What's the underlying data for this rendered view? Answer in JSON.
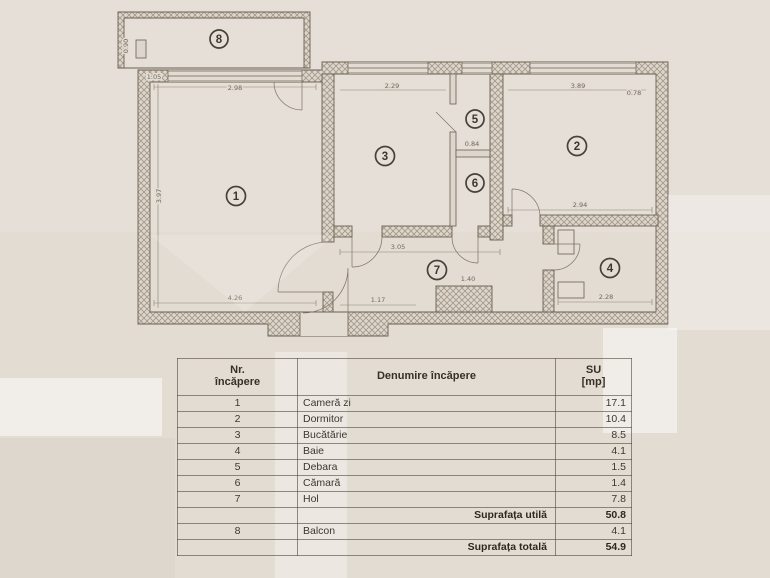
{
  "plan": {
    "room_numbers": [
      "1",
      "2",
      "3",
      "4",
      "5",
      "6",
      "7",
      "8"
    ],
    "dimension_labels": [
      "2.98",
      "3.97",
      "4.26",
      "2.29",
      "3.89",
      "0.78",
      "2.94",
      "2.28",
      "3.05",
      "1.17",
      "0.84",
      "1.40",
      "1.05",
      "0.90"
    ],
    "colors": {
      "paper": "#e3dcd3",
      "line": "#6a6052",
      "hatch": "#a39a8c",
      "ink": "#3d382f"
    }
  },
  "table": {
    "header": {
      "nr_line1": "Nr.",
      "nr_line2": "încăpere",
      "name": "Denumire încăpere",
      "su_line1": "SU",
      "su_line2": "[mp]"
    },
    "rows": [
      {
        "nr": "1",
        "name": "Cameră zi",
        "su": "17.1"
      },
      {
        "nr": "2",
        "name": "Dormitor",
        "su": "10.4"
      },
      {
        "nr": "3",
        "name": "Bucătărie",
        "su": "8.5"
      },
      {
        "nr": "4",
        "name": "Baie",
        "su": "4.1"
      },
      {
        "nr": "5",
        "name": "Debara",
        "su": "1.5"
      },
      {
        "nr": "6",
        "name": "Cămară",
        "su": "1.4"
      },
      {
        "nr": "7",
        "name": "Hol",
        "su": "7.8"
      },
      {
        "nr": "",
        "name": "Suprafața utilă",
        "su": "50.8"
      },
      {
        "nr": "8",
        "name": "Balcon",
        "su": "4.1"
      },
      {
        "nr": "",
        "name": "Suprafața totală",
        "su": "54.9"
      }
    ]
  }
}
